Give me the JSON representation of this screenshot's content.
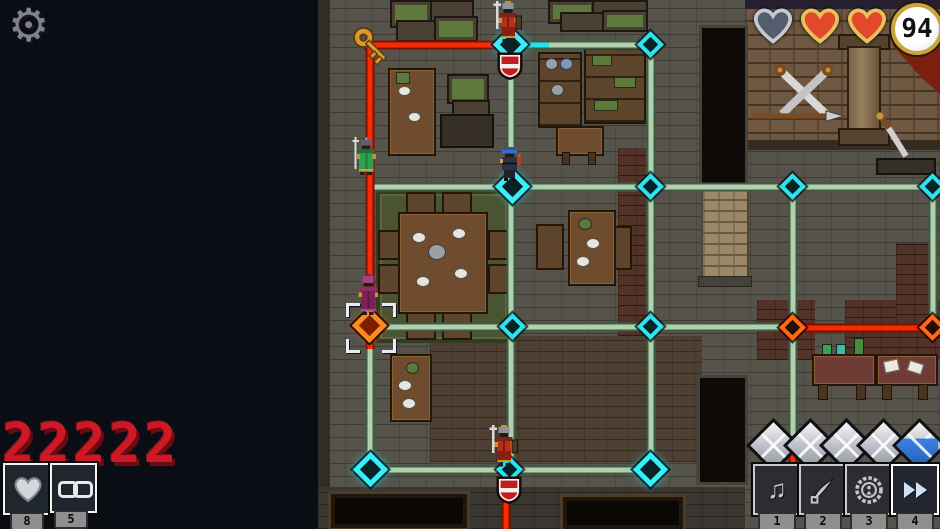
{
  "hud": {
    "settings": {
      "icon": "gear"
    },
    "status": {
      "hearts": [
        "empty-silver",
        "full-red",
        "full-red"
      ],
      "coins": "94"
    },
    "score": "22222",
    "abilities": [
      {
        "icon": "heart",
        "count": "8"
      },
      {
        "icon": "chain-link",
        "count": "5"
      }
    ],
    "gems": [
      "silver",
      "silver",
      "silver",
      "silver",
      "blue-partial"
    ],
    "actions": [
      {
        "icon": "music-note",
        "hotkey": "1",
        "selected": false
      },
      {
        "icon": "quill",
        "hotkey": "2",
        "selected": false
      },
      {
        "icon": "round-seal",
        "hotkey": "3",
        "selected": false
      },
      {
        "icon": "fast-forward",
        "hotkey": "4",
        "selected": true
      }
    ]
  },
  "map": {
    "units": [
      {
        "id": "red-knight-north",
        "color": "#b5301c"
      },
      {
        "id": "green-halberdier",
        "color": "#2da14e"
      },
      {
        "id": "blue-captain",
        "color": "#3c6cd1"
      },
      {
        "id": "purple-acolyte",
        "color": "#8c2f66"
      },
      {
        "id": "red-knight-south",
        "color": "#b5301c"
      }
    ],
    "items": [
      {
        "id": "gold-key"
      }
    ],
    "markers": [
      {
        "id": "crest-north"
      },
      {
        "id": "crest-south"
      }
    ],
    "paths": {
      "patrol_color": "#b2cfae",
      "alert_color": "#f72b04",
      "node_color": "#2ae4f0",
      "alert_node_color": "#ff6a1a"
    }
  }
}
